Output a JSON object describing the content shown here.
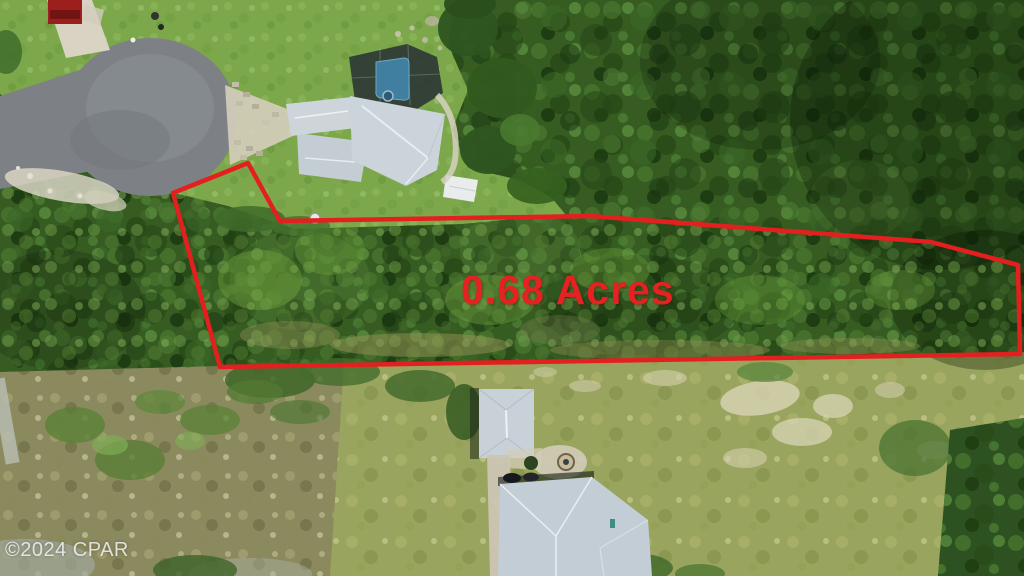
{
  "overlay": {
    "acreage_label": "0.68 Acres",
    "acreage_color": "#e62121",
    "boundary_color": "#e41f1f"
  },
  "watermark": {
    "text": "©2024 CPAR",
    "color": "#f8f8f8"
  }
}
